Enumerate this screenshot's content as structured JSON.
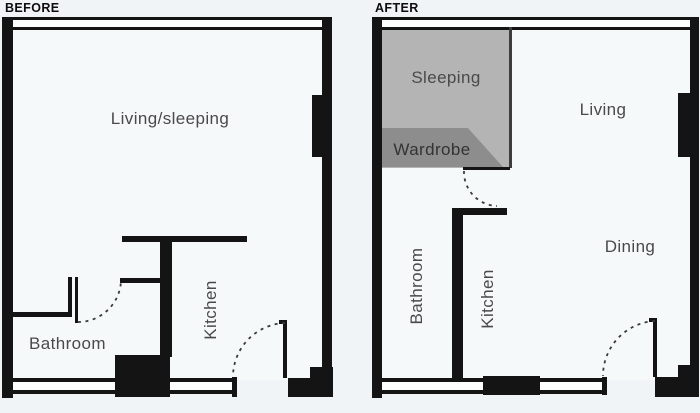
{
  "diagram_title": "Floor plan comparison",
  "colors": {
    "wall": "#141414",
    "background": "#f1f4f6",
    "sleeping_fill": "#b4b4b4",
    "wardrobe_fill": "#8d8d8d",
    "label_text": "#4a4a4a"
  },
  "before": {
    "header": "BEFORE",
    "rooms": {
      "living_sleeping": "Living/sleeping",
      "bathroom": "Bathroom",
      "kitchen": "Kitchen"
    }
  },
  "after": {
    "header": "AFTER",
    "rooms": {
      "sleeping": "Sleeping",
      "wardrobe": "Wardrobe",
      "living": "Living",
      "dining": "Dining",
      "bathroom": "Bathroom",
      "kitchen": "Kitchen"
    }
  }
}
